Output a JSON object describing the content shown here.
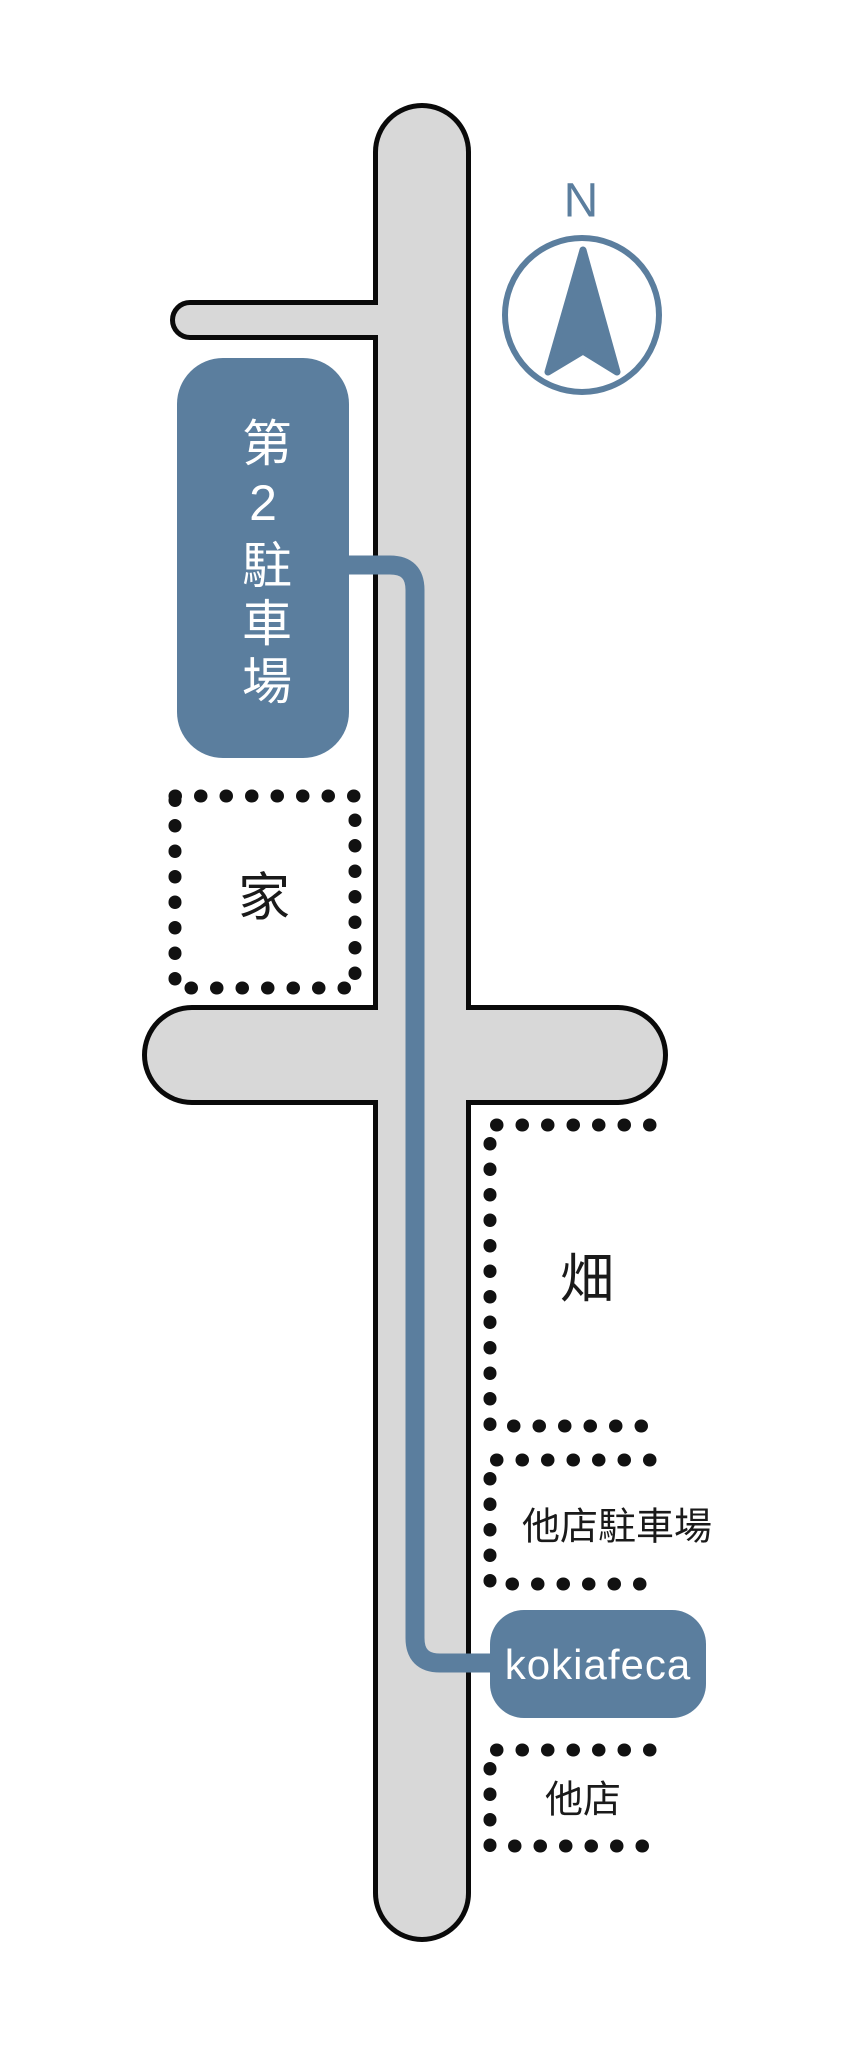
{
  "map": {
    "compass": {
      "label": "N"
    },
    "locations": {
      "parking2": {
        "label": "第2駐車場"
      },
      "house": {
        "label": "家"
      },
      "field": {
        "label": "畑"
      },
      "other_store_parking": {
        "label": "他店駐車場"
      },
      "destination": {
        "label": "kokiafeca"
      },
      "other_store": {
        "label": "他店"
      }
    },
    "colors": {
      "accent_blue": "#5b7e9e",
      "road_fill": "#d8d8d8",
      "road_outline": "#0a0a0a",
      "dot_black": "#111111"
    }
  }
}
